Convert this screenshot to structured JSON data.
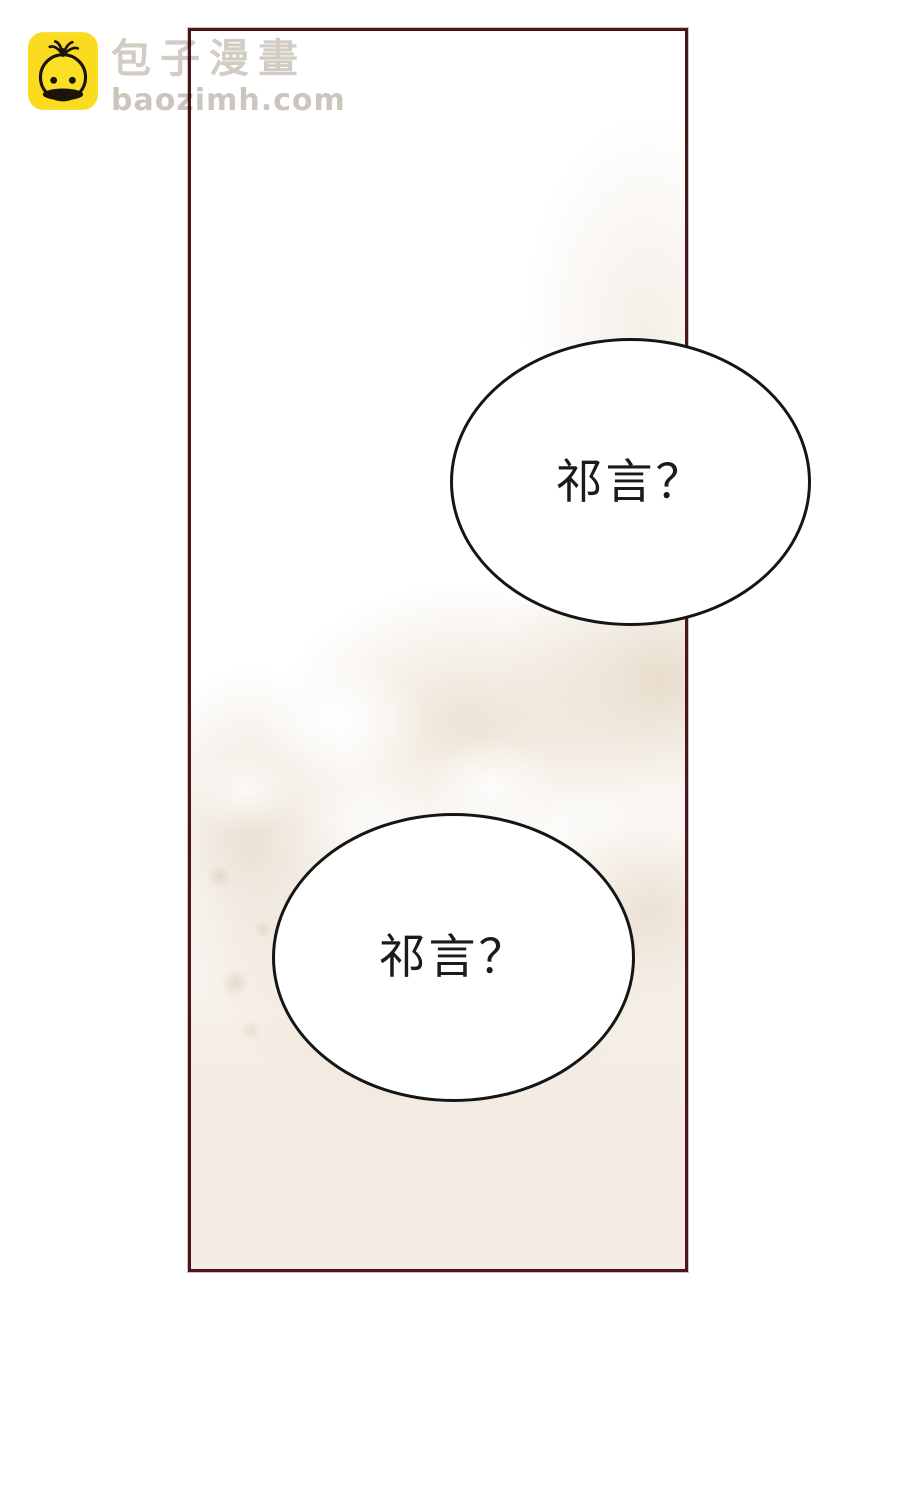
{
  "watermark": {
    "site_name": "包子漫畫",
    "site_url": "baozimh.com"
  },
  "bubbles": [
    {
      "text": "祁言？"
    },
    {
      "text": "祁言？"
    }
  ],
  "colors": {
    "page_background": "#ffffff",
    "panel_border": "#4b161b",
    "panel_beige": "#f4ece4",
    "panel_wash": "#e9decf",
    "bubble_fill": "#ffffff",
    "bubble_border": "#151515",
    "bubble_text": "#1b1b1b",
    "logo_yellow": "#fbdb1f",
    "logo_line": "#1a140b",
    "watermark_text": "#d2ccc4"
  }
}
